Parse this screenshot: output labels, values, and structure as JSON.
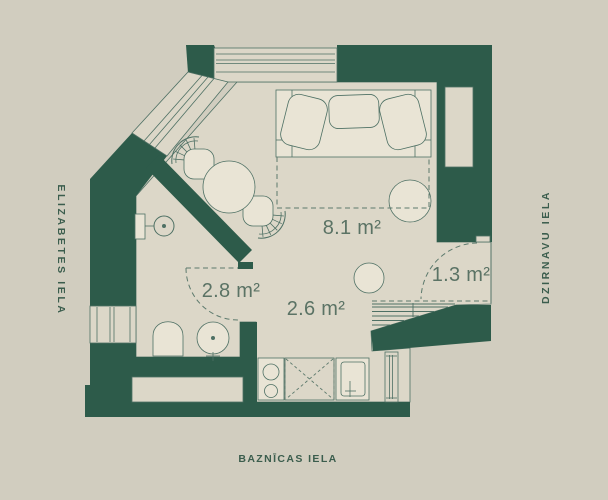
{
  "plan": {
    "title": "studio-apartment-floor-plan",
    "streets": {
      "left": "ELIZABETES IELA",
      "right": "DZIRNAVU IELA",
      "bottom": "BAZNĪCAS IELA"
    },
    "areas": {
      "living": "8.1 m²",
      "bathroom": "2.8 m²",
      "kitchen": "2.6 m²",
      "entry": "1.3 m²"
    },
    "colors": {
      "background": "#d1cdbf",
      "floor": "#dcd7c8",
      "wall": "#2d5b4a",
      "furniture": "#e9e4d5",
      "outline": "#4e7064",
      "street_text": "#3b5d4d",
      "area_text": "#5b7365"
    }
  }
}
